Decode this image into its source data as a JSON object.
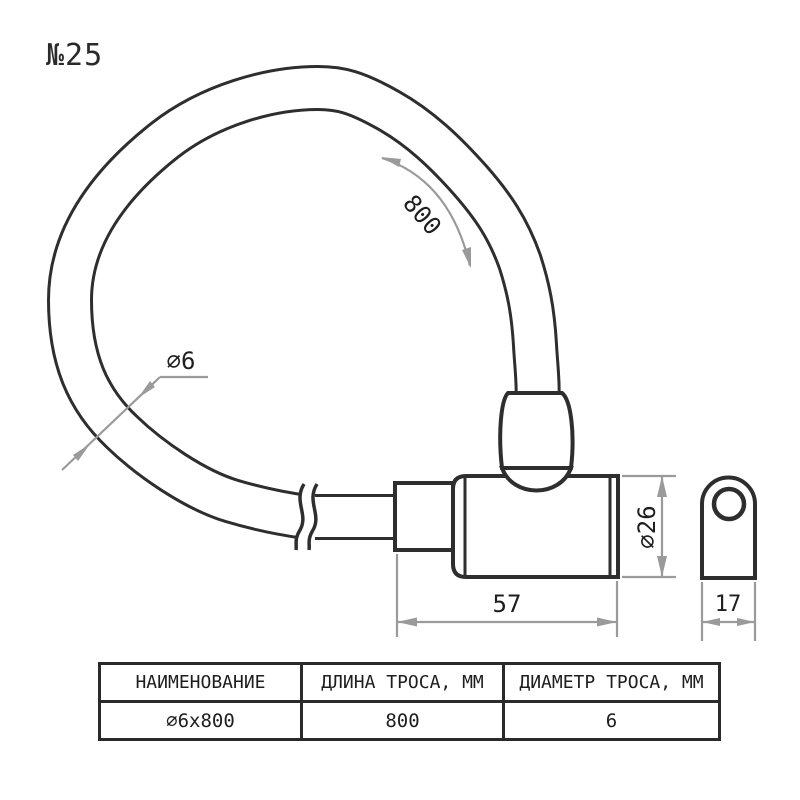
{
  "title": "№25",
  "dims": {
    "cable_length": "800",
    "cable_diameter": "∅6",
    "body_diameter": "∅26",
    "body_length": "57",
    "end_width": "17"
  },
  "colors": {
    "line": "#2e2e2e",
    "dimension": "#9a9a9a",
    "text": "#1e1e1e",
    "background": "#ffffff"
  },
  "table": {
    "headers": [
      "НАИМЕНОВАНИЕ",
      "ДЛИНА ТРОСА, ММ",
      "ДИАМЕТР ТРОСА, ММ"
    ],
    "row": [
      "∅6x800",
      "800",
      "6"
    ]
  }
}
